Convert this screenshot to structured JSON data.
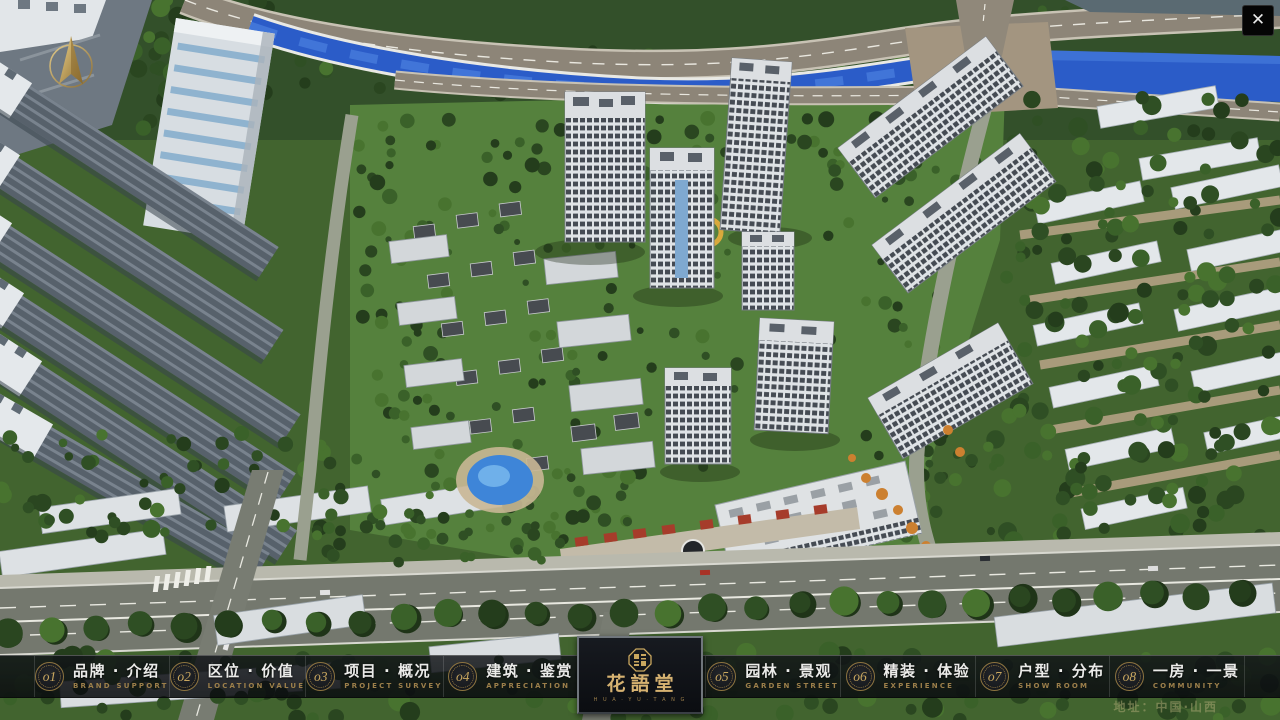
{
  "palette": {
    "gold": "#c9a75f",
    "goldDim": "#9c7f4a",
    "goldDeep": "#8d7440",
    "barBg": "rgba(17,20,24,.84)",
    "panelBg": "#101318",
    "txt": "#ebebe9",
    "riverBlue": "#2b5cc8",
    "accentRed": "#a63c2b"
  },
  "window": {
    "close_glyph": "✕"
  },
  "nav": {
    "items": [
      {
        "num": "o1",
        "zh": "品牌 · 介绍",
        "en": "BRAND SUPPORT"
      },
      {
        "num": "o2",
        "zh": "区位 · 价值",
        "en": "LOCATION VALUE"
      },
      {
        "num": "o3",
        "zh": "项目 · 概况",
        "en": "PROJECT SURVEY"
      },
      {
        "num": "o4",
        "zh": "建筑 · 鉴赏",
        "en": "APPRECIATION"
      },
      {
        "num": "o5",
        "zh": "园林 · 景观",
        "en": "GARDEN STREET"
      },
      {
        "num": "o6",
        "zh": "精装 · 体验",
        "en": "EXPERIENCE"
      },
      {
        "num": "o7",
        "zh": "户型 · 分布",
        "en": "SHOW ROOM"
      },
      {
        "num": "o8",
        "zh": "一房 · 一景",
        "en": "COMMUNITY"
      }
    ],
    "logo": {
      "title": "花語堂",
      "subtitle": "H U A · Y U · T A N G"
    },
    "address": "地址：中国·山西"
  }
}
